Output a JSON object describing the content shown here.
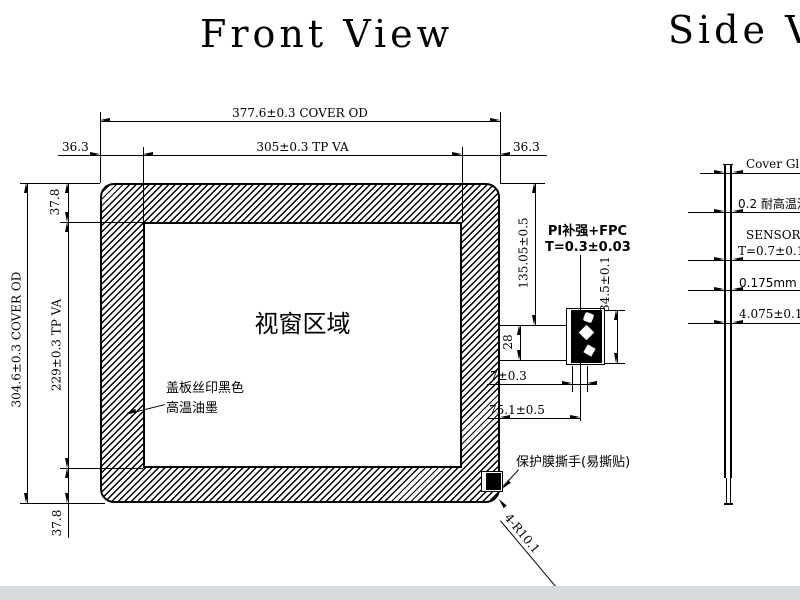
{
  "colors": {
    "ink": "#000000",
    "background": "#ffffff",
    "footer_bar": "#d6d9de"
  },
  "titles": {
    "front": "Front View",
    "side": "Side View"
  },
  "front_view": {
    "window_label": "视窗区域",
    "ink_note": {
      "line1": "盖板丝印黑色",
      "line2": "高温油墨"
    },
    "fpc_note": {
      "line1": "PI补强+FPC",
      "line2": "T=0.3±0.03"
    },
    "film_note": "保护膜撕手(易撕贴)",
    "corner_note": "4-R10.1",
    "dims": {
      "cover_width": "377.6±0.3 COVER OD",
      "tp_width": "305±0.3 TP VA",
      "side_margin": "36.3",
      "cover_height": "304.6±0.3 COVER OD",
      "tp_height": "229±0.3 TP VA",
      "top_bottom_margin": "37.8",
      "fpc_top_offset": "135.05±0.5",
      "fpc_exit_width": "28",
      "fpc_connector_height": "34.5±0.1",
      "fpc_small_offset": "7±0.3",
      "fpc_center_from_edge": "75.1±0.5"
    }
  },
  "side_view": {
    "layers": [
      {
        "label": "Cover Glass"
      },
      {
        "label": "0.2 耐高温油墨"
      },
      {
        "label": "SENSOR GLASS",
        "thickness": "T=0.7±0.1"
      },
      {
        "label": "0.175mm 双面胶"
      },
      {
        "label": "4.075±0.1"
      }
    ]
  }
}
